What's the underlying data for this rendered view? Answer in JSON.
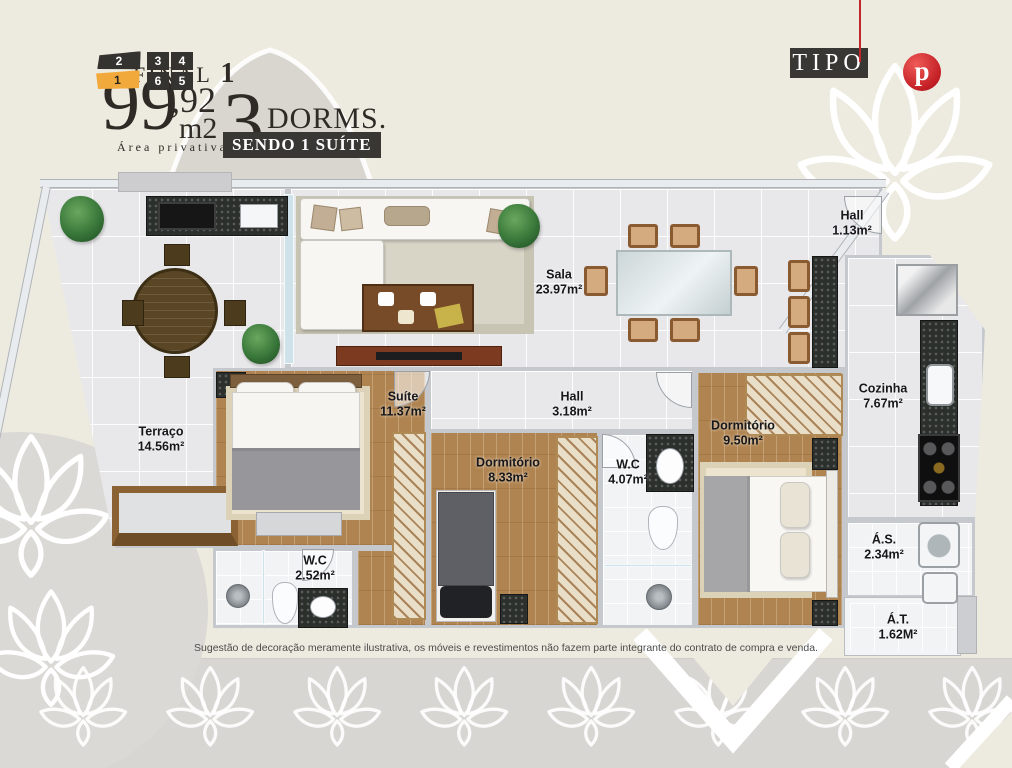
{
  "header": {
    "final_label": "FINAL",
    "final_number": "1",
    "area_integer": "99",
    "area_fraction": ",92",
    "area_unit": "m2",
    "area_caption": "Área privativa",
    "dorms_count": "3",
    "dorms_label": "DORMS.",
    "suite_banner": "SENDO 1 SUÍTE"
  },
  "badge": {
    "tipo": "TIPO",
    "logo_letter": "p"
  },
  "unit_selector": {
    "stack_units": [
      {
        "label": "2",
        "active": false
      },
      {
        "label": "1",
        "active": true
      }
    ],
    "grid_units": [
      {
        "label": "3"
      },
      {
        "label": "4"
      },
      {
        "label": "6"
      },
      {
        "label": "5"
      }
    ]
  },
  "rooms": [
    {
      "name": "Hall",
      "area": "1.13m²"
    },
    {
      "name": "Sala",
      "area": "23.97m²"
    },
    {
      "name": "Terraço",
      "area": "14.56m²"
    },
    {
      "name": "Suíte",
      "area": "11.37m²"
    },
    {
      "name": "Hall",
      "area": "3.18m²"
    },
    {
      "name": "Dormitório",
      "area": "8.33m²"
    },
    {
      "name": "W.C",
      "area": "4.07m²"
    },
    {
      "name": "Dormitório",
      "area": "9.50m²"
    },
    {
      "name": "Cozinha",
      "area": "7.67m²"
    },
    {
      "name": "W.C",
      "area": "2.52m²"
    },
    {
      "name": "Á.S.",
      "area": "2.34m²"
    },
    {
      "name": "Á.T.",
      "area": "1.62M²"
    }
  ],
  "disclaimer": "Sugestão de decoração meramente ilustrativa, os móveis e revestimentos não fazem parte integrante do contrato de compra e venda.",
  "colors": {
    "background": "#edeadf",
    "band_gray": "#d8d6d2",
    "dark_box": "#393734",
    "accent_yellow": "#f2a93b",
    "brand_red": "#c1272d",
    "wood": "#b08450",
    "granite": "#2c302d"
  }
}
